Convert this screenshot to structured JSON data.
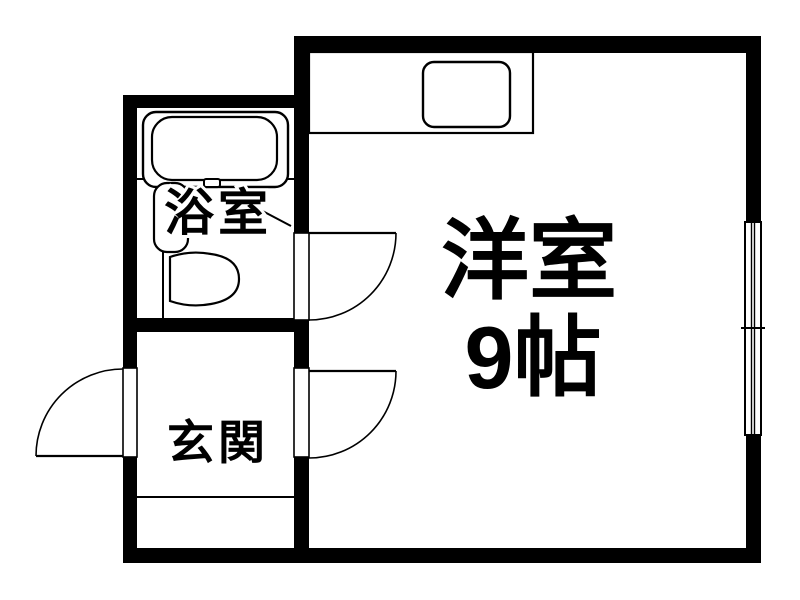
{
  "floor_plan": {
    "type": "apartment-floor-plan",
    "background_color": "#ffffff",
    "wall_color": "#000000",
    "line_color": "#000000",
    "rooms": {
      "western_room": {
        "label": "洋室",
        "size": "9帖"
      },
      "bathroom": {
        "label": "浴室"
      },
      "entrance": {
        "label": "玄関"
      }
    },
    "fixtures": [
      "bathtub",
      "washbasin",
      "toilet",
      "kitchen-counter",
      "kitchen-sink",
      "sliding-window",
      "entrance-step"
    ],
    "doors": [
      "front-door",
      "entrance-room-door",
      "bathroom-door"
    ]
  }
}
